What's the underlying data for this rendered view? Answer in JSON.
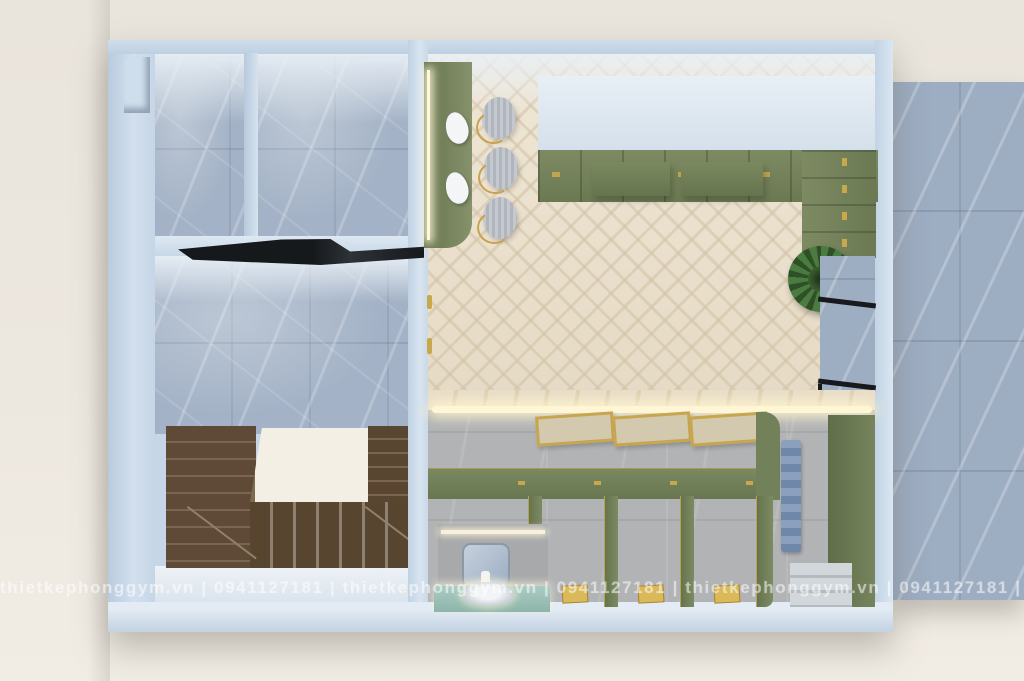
{
  "watermark": {
    "text": "thietkephonggym.vn | 0941127181 | thietkephonggym.vn | 0941127181 | thietkephonggym.vn | 0941127181 | thietkephonggym.vn",
    "color": "#ffffff",
    "opacity": 0.5
  },
  "scene": {
    "type": "3d-top-down-floor-plan-render",
    "areas": [
      "marble-room-top-left",
      "marble-room-top-center",
      "marble-lounge",
      "u-shaped-wood-staircase",
      "salon-locker-room-herringbone",
      "mirror-console-with-led",
      "locker-wall-l-shaped",
      "benches",
      "plant",
      "shower-stall-area",
      "vanity-sink",
      "outdoor-marble-terrace"
    ],
    "colors": {
      "background_cream": "#ece7df",
      "wall_blue": "#c6d6e6",
      "marble_blue_gray": "#a3b2c6",
      "herringbone_wood": "#eae0cd",
      "cabinet_green": "#78865f",
      "stair_wood_brown": "#5e4a37",
      "accent_gold": "#c9a84c",
      "shower_tile_gray": "#b1b3b5",
      "towel_blue": "#8aa0bd",
      "plant_green": "#4a7c3f"
    }
  }
}
